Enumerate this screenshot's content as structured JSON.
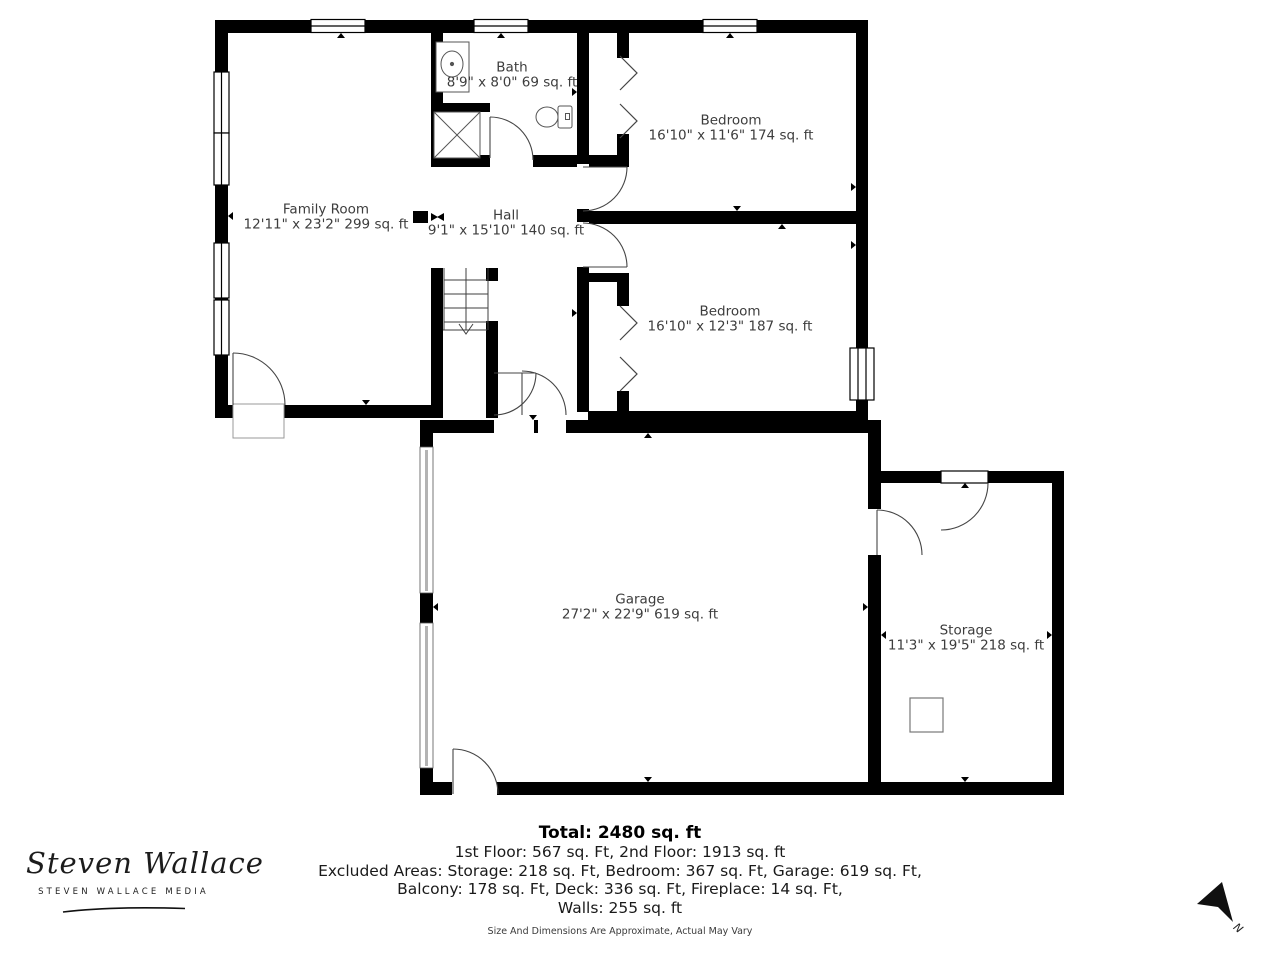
{
  "plan": {
    "rooms": [
      {
        "name": "Bath",
        "dims": "8'9\" x 8'0\" 69 sq. ft"
      },
      {
        "name": "Bedroom",
        "dims": "16'10\" x 11'6\" 174 sq. ft"
      },
      {
        "name": "Family Room",
        "dims": "12'11\" x 23'2\" 299 sq. ft"
      },
      {
        "name": "Hall",
        "dims": "9'1\" x 15'10\" 140 sq. ft"
      },
      {
        "name": "Bedroom",
        "dims": "16'10\" x 12'3\" 187 sq. ft"
      },
      {
        "name": "Garage",
        "dims": "27'2\" x 22'9\" 619 sq. ft"
      },
      {
        "name": "Storage",
        "dims": "11'3\" x 19'5\" 218 sq. ft"
      }
    ]
  },
  "summary": {
    "total": "Total: 2480 sq. ft",
    "floors": "1st Floor: 567 sq. Ft, 2nd Floor: 1913 sq. ft",
    "excluded_line1": "Excluded Areas: Storage: 218 sq. Ft, Bedroom: 367 sq. Ft, Garage: 619 sq. Ft,",
    "excluded_line2": "Balcony: 178 sq. Ft, Deck: 336 sq. Ft, Fireplace: 14 sq. Ft,",
    "walls": "Walls: 255 sq. ft",
    "disclaimer": "Size And Dimensions Are Approximate, Actual May Vary"
  },
  "branding": {
    "name": "Steven Wallace",
    "tagline": "STEVEN WALLACE MEDIA"
  },
  "compass": {
    "north_label": "N"
  },
  "colors": {
    "walls": "#000000",
    "room_text": "#3d3d3d",
    "summary_text": "#1a1a1a"
  }
}
